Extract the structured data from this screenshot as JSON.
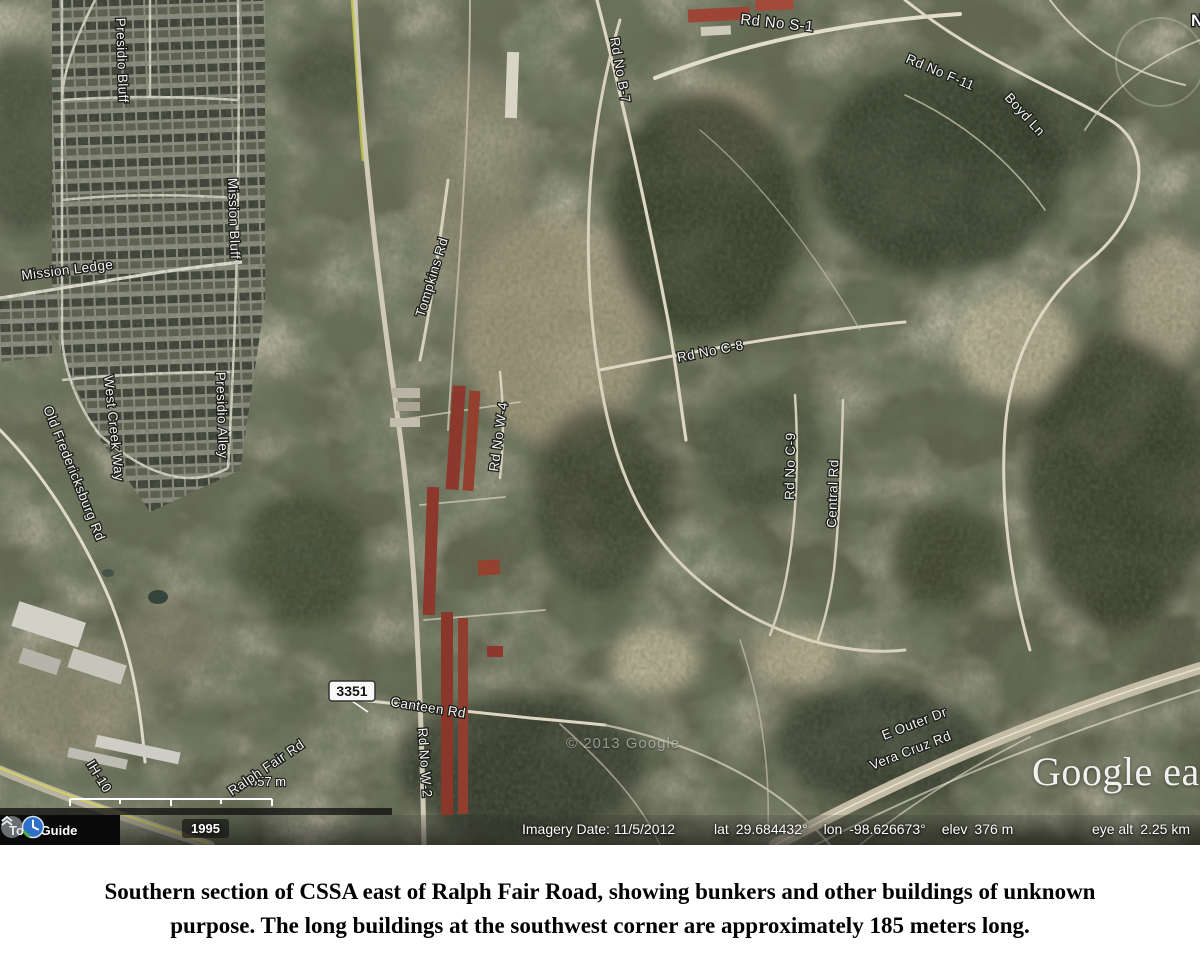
{
  "map": {
    "compass_label": "N",
    "copyright": "© 2013 Google",
    "logo_text": "Google ear",
    "highway_shield": "3351",
    "scale_label": "557 m",
    "road_labels": [
      {
        "text": "Presidio Bluff"
      },
      {
        "text": "Mission Bluff"
      },
      {
        "text": "Mission Ledge"
      },
      {
        "text": "Presidio Alley"
      },
      {
        "text": "West Creek Way"
      },
      {
        "text": "Old Fredericksburg Rd"
      },
      {
        "text": "Rd No S-1"
      },
      {
        "text": "Rd No B-7"
      },
      {
        "text": "Rd No F-11"
      },
      {
        "text": "Boyd Ln"
      },
      {
        "text": "Rd No C-8"
      },
      {
        "text": "Rd No C-9"
      },
      {
        "text": "Central Rd"
      },
      {
        "text": "Tompkins Rd"
      },
      {
        "text": "Rd No W-4"
      },
      {
        "text": "Canteen Rd"
      },
      {
        "text": "Rd No W-2"
      },
      {
        "text": "Ralph Fair Rd"
      },
      {
        "text": "IH-10"
      },
      {
        "text": "E Outer Dr"
      },
      {
        "text": "Vera Cruz Rd"
      }
    ]
  },
  "status_bar": {
    "tour_guide_label": "Tour Guide",
    "time_slider_year": "1995",
    "imagery_date": "Imagery Date: 11/5/2012",
    "lat_label": "lat",
    "lat_value": "29.684432°",
    "lon_label": "lon",
    "lon_value": "-98.626673°",
    "elev_label": "elev",
    "elev_value": "376 m",
    "eye_alt_label": "eye alt",
    "eye_alt_value": "2.25 km"
  },
  "caption": {
    "line1": "Southern section of CSSA east of Ralph Fair Road, showing bunkers and other buildings of unknown",
    "line2": "purpose. The long buildings at the southwest corner are approximately 185 meters long."
  }
}
